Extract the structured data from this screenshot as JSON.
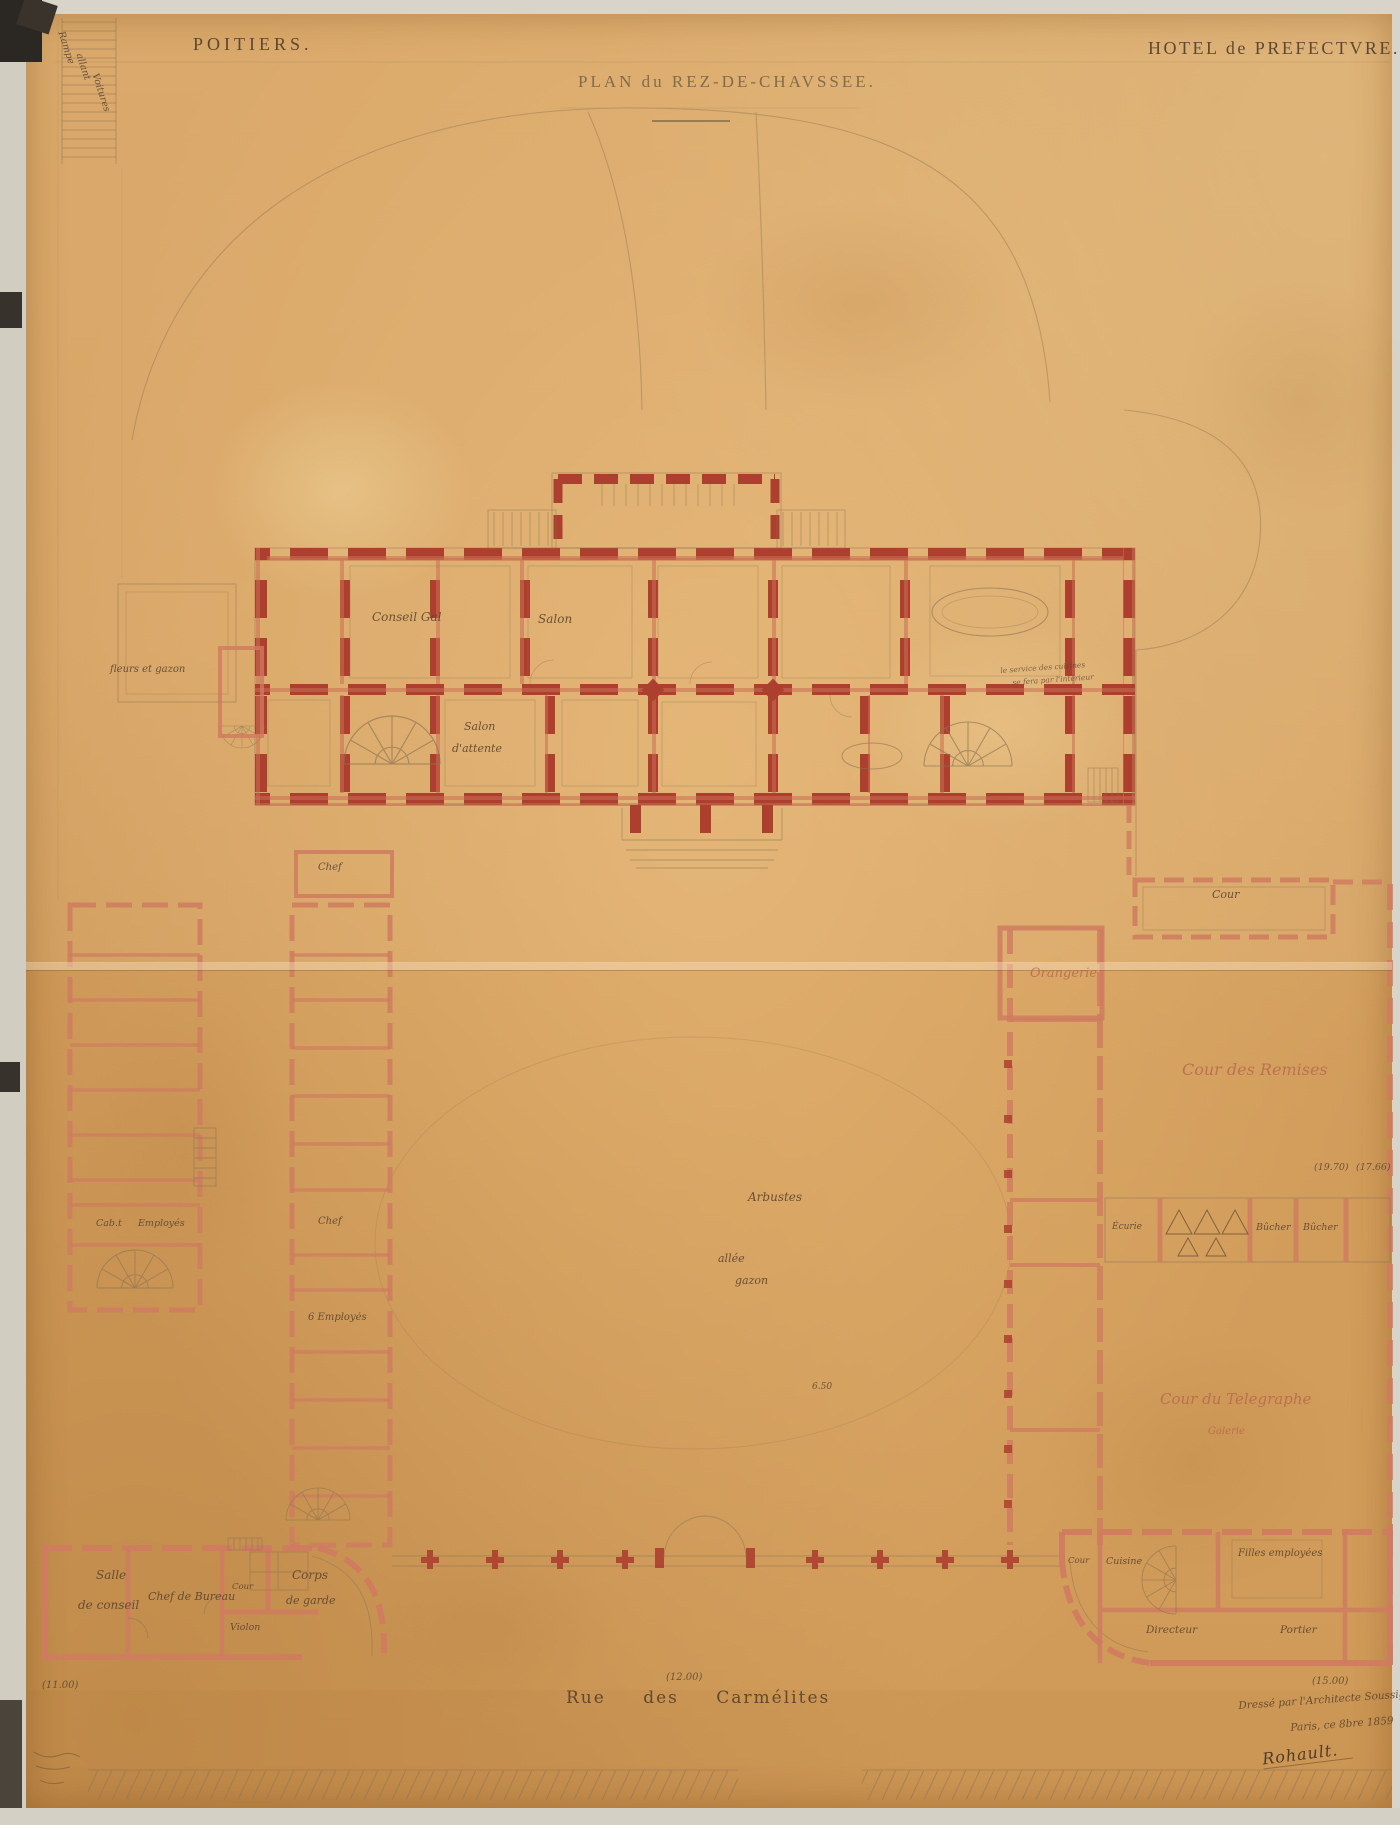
{
  "header": {
    "city": "POITIERS.",
    "title": "PLAN du REZ-DE-CHAVSSEE.",
    "building": "HOTEL de PREFECTVRE."
  },
  "ramp": {
    "l1": "Rampe",
    "l2": "allant",
    "l3": "Voitures"
  },
  "main_rooms": {
    "conseil": "Conseil Gal",
    "salon": "Salon",
    "salon_attente_1": "Salon",
    "salon_attente_2": "d'attente",
    "chef": "Chef",
    "note_1": "le service des cuisines",
    "note_2": "se fera par l'intérieur"
  },
  "courts": {
    "cour_ne": "Cour",
    "orangerie": "Orangerie",
    "cour_des_remises": "Cour des Remises",
    "cour_du_telegraphe": "Cour du Telegraphe",
    "galerie": "Galerie"
  },
  "garden": {
    "arbustes": "Arbustes",
    "allee": "allée",
    "gazon": "gazon",
    "fleurs_et_gazon": "fleurs et gazon"
  },
  "west_wing": {
    "cabt": "Cab.t",
    "employes": "Employés",
    "chef": "Chef",
    "six_employes": "6 Employés"
  },
  "sheds": {
    "ecurie": "Écurie",
    "bucher_1": "Bûcher",
    "bucher_2": "Bûcher"
  },
  "southwest_block": {
    "salle_1": "Salle",
    "salle_2": "de conseil",
    "chef_de_bureau": "Chef de Bureau",
    "cour": "Cour",
    "violon": "Violon",
    "corps_1": "Corps",
    "corps_2": "de garde"
  },
  "southeast_block": {
    "cour": "Cour",
    "cuisine": "Cuisine",
    "filles": "Filles employées",
    "directeur": "Directeur",
    "portier": "Portier"
  },
  "dimensions": {
    "w11": "(11.00)",
    "w12": "(12.00)",
    "w15": "(15.00)",
    "d1970": "(19.70)",
    "d1766": "(17.66)",
    "d650": "6.50"
  },
  "street": {
    "name": "Rue des Carmélites"
  },
  "signature": {
    "line1": "Dressé par l'Architecte Soussigné",
    "line2": "Paris, ce 8bre 1859",
    "name": "Rohault."
  },
  "colors": {
    "paper": "#d6a261",
    "wall_red": "#ad3f2f",
    "wall_pink": "#cf7b5f",
    "pencil": "#8a7455",
    "ink": "#5c4730",
    "court_ink": "#b86a4e"
  }
}
